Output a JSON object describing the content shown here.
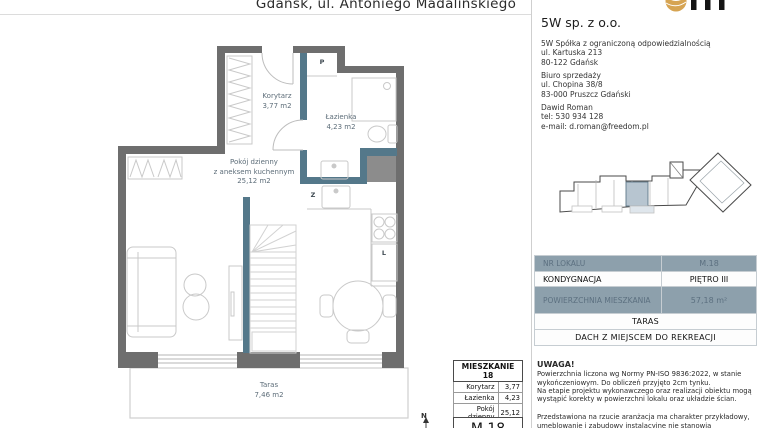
{
  "header": {
    "title": "Gdańsk, ul. Antoniego Madalińskiego"
  },
  "company": {
    "name": "5W sp. z o.o.",
    "legal": [
      "5W Spółka z ograniczoną odpowiedzialnością",
      "ul. Kartuska 213",
      "80-122 Gdańsk"
    ],
    "office": [
      "Biuro sprzedaży",
      "ul. Chopina 38/8",
      "83-000 Pruszcz Gdański"
    ],
    "agent": [
      "Dawid Roman",
      "tel: 530 934 128",
      "e-mail: d.roman@freedom.pl"
    ]
  },
  "plan": {
    "rooms": {
      "korytarz": {
        "name": "Korytarz",
        "area": "3,77 m2"
      },
      "lazienka": {
        "name": "Łazienka",
        "area": "4,23 m2"
      },
      "pokoj": {
        "line1": "Pokój dzienny",
        "line2": "z aneksem kuchennym",
        "area": "25,12 m2"
      },
      "taras": {
        "name": "Taras",
        "area": "7,46 m2"
      }
    },
    "markers": {
      "p": "P",
      "z": "Z",
      "l": "L",
      "north": "N"
    }
  },
  "unit_table": {
    "rows": [
      {
        "label": "NR LOKALU",
        "value": "M.18"
      },
      {
        "label": "KONDYGNACJA",
        "value": "PIĘTRO III"
      },
      {
        "label": "POWIERZCHNIA MIESZKANIA",
        "value": "57,18 m²"
      }
    ],
    "full_rows": [
      "TARAS",
      "DACH Z MIEJSCEM DO REKREACJI"
    ]
  },
  "apartment_table": {
    "title": "MIESZKANIE 18",
    "rows": [
      {
        "label": "Korytarz",
        "value": "3,77"
      },
      {
        "label": "Łazienka",
        "value": "4,23"
      },
      {
        "label": "Pokój dzienny",
        "value": "25,12"
      },
      {
        "label": "Antresola",
        "value": "24,06"
      }
    ],
    "unit_code": "M.18"
  },
  "notes": {
    "heading": "UWAGA!",
    "para1": "Powierzchnia liczona wg Normy PN-ISO 9836:2022, w stanie wykończeniowym. Do obliczeń przyjęto 2cm tynku.",
    "para2": "Na etapie projektu wykonawczego oraz realizacji obiektu mogą wystąpić korekty w powierzchni lokalu oraz układzie ścian.",
    "para3": "Przedstawiona na rzucie aranżacja ma charakter przykładowy, umeblowanie i zabudowy instalacyjne nie stanowią wyposażenia"
  },
  "colors": {
    "wall_gray": "#6e6e6e",
    "wall_partition_teal": "#54788a",
    "shaft_gray": "#8c8c8c",
    "furniture_line": "#c9c9c9",
    "table_header_bg": "#8da0ac",
    "table_header_text": "#5c7080",
    "highlight_unit": "#b7c5d0",
    "logo_gold": "#d6a452"
  }
}
